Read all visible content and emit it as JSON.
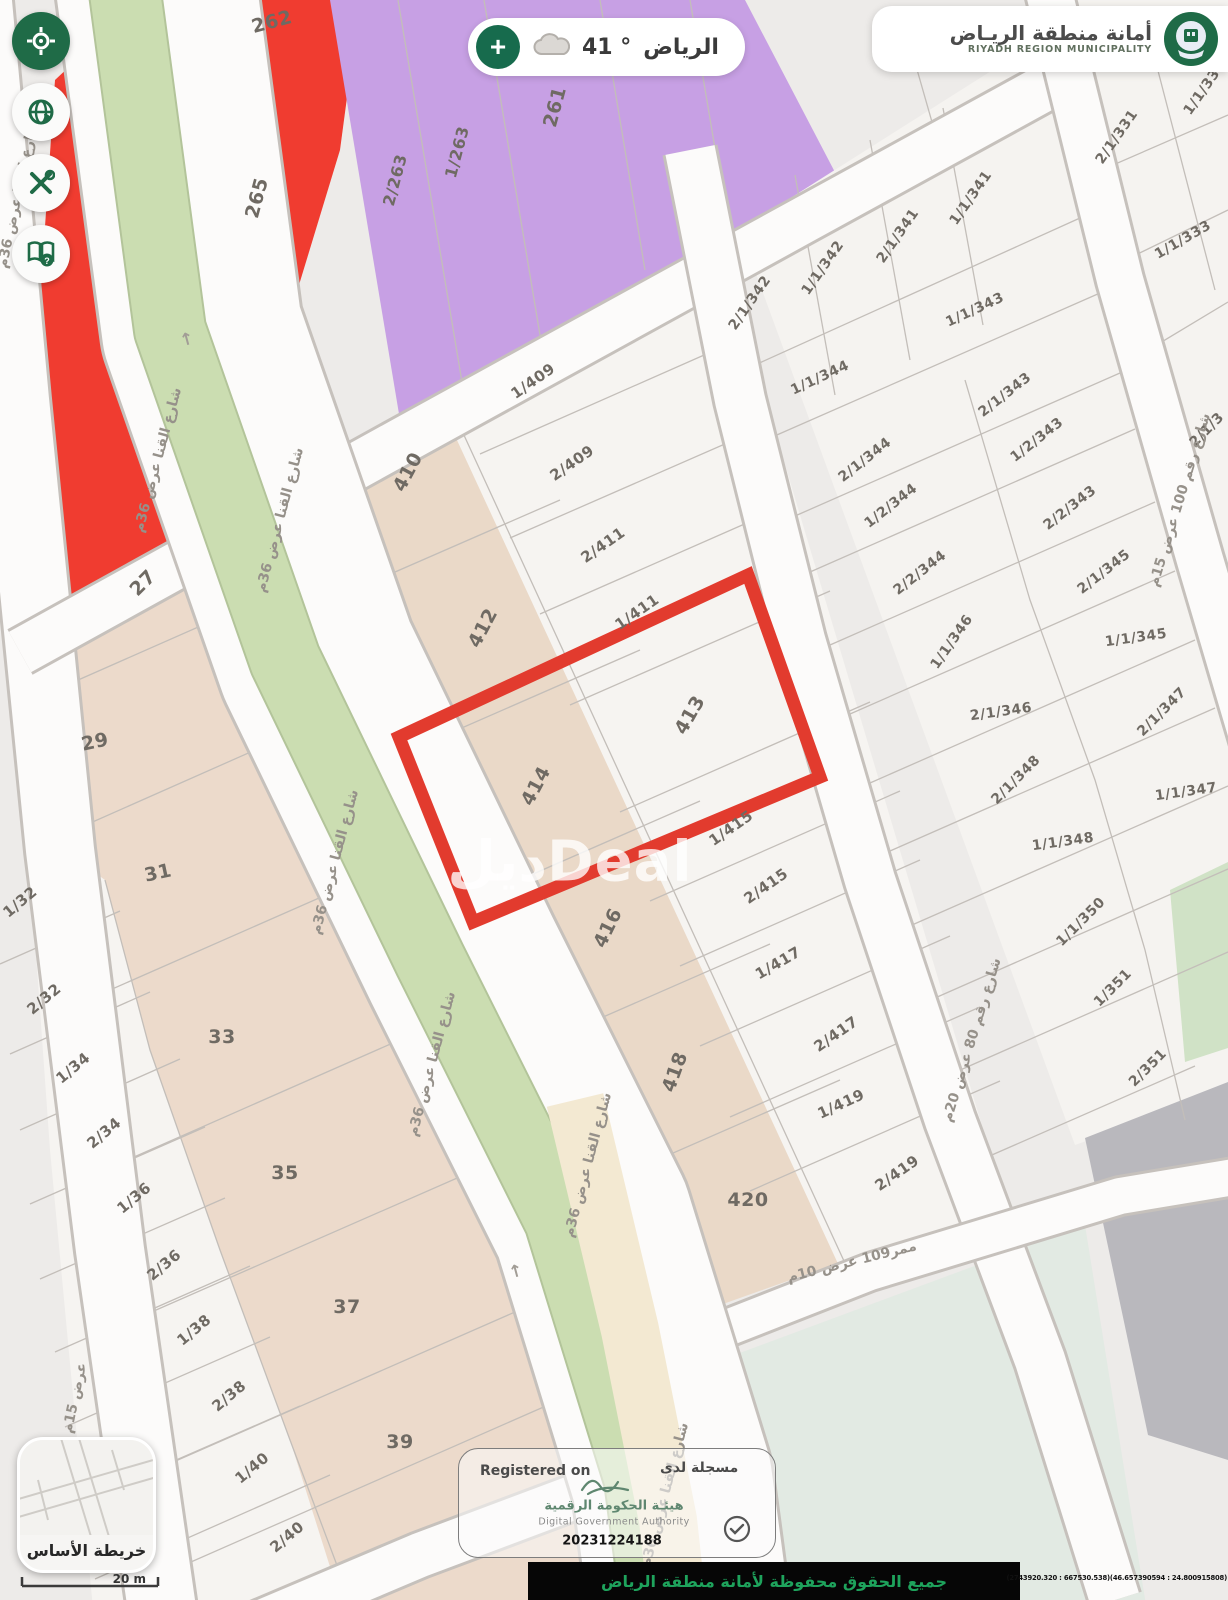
{
  "header": {
    "municipality": {
      "title_ar": "أمانة منطقة الريـاض",
      "title_en": "RIYADH REGION MUNICIPALITY"
    },
    "weather": {
      "city": "الرياض",
      "temp": "41",
      "degree_symbol": "°"
    }
  },
  "toolbar": {
    "buttons": [
      {
        "icon": "locate-target-icon"
      },
      {
        "icon": "globe-icon"
      },
      {
        "icon": "tools-icon"
      },
      {
        "icon": "help-book-icon"
      }
    ]
  },
  "map": {
    "watermark": "ديلDeal",
    "arrow_glyph": "↑",
    "highlight_color": "#e23b2e",
    "colors": {
      "background": "#edebe9",
      "street": "#fcfbfa",
      "street_border": "#c6c1bc",
      "parcel_white": "#f6f4f1",
      "parcel_beige": "#ead9c8",
      "parcel_red": "#f03c30",
      "parcel_purple": "#c7a0e4",
      "median_green": "#cbddb1",
      "parcel_mint": "#e2eae3",
      "parcel_gray": "#b9b8bd",
      "parcel_green": "#d0e2c6",
      "road_cream": "#f3e9d2"
    },
    "parcel_labels": [
      {
        "t": "262",
        "x": 272,
        "y": 22,
        "r": -15,
        "s": 19
      },
      {
        "t": "265",
        "x": 257,
        "y": 198,
        "r": -75,
        "s": 19
      },
      {
        "t": "2/263",
        "x": 395,
        "y": 180,
        "r": -75,
        "s": 16
      },
      {
        "t": "1/263",
        "x": 457,
        "y": 152,
        "r": -75,
        "s": 16
      },
      {
        "t": "261",
        "x": 555,
        "y": 107,
        "r": -75,
        "s": 19
      },
      {
        "t": "410",
        "x": 408,
        "y": 472,
        "r": -62,
        "s": 19
      },
      {
        "t": "412",
        "x": 483,
        "y": 628,
        "r": -62,
        "s": 19
      },
      {
        "t": "414",
        "x": 536,
        "y": 786,
        "r": -62,
        "s": 19
      },
      {
        "t": "416",
        "x": 608,
        "y": 928,
        "r": -64,
        "s": 19
      },
      {
        "t": "418",
        "x": 675,
        "y": 1072,
        "r": -70,
        "s": 19
      },
      {
        "t": "420",
        "x": 748,
        "y": 1200,
        "r": 0,
        "s": 19
      },
      {
        "t": "413",
        "x": 690,
        "y": 715,
        "r": -60,
        "s": 19
      },
      {
        "t": "1/409",
        "x": 533,
        "y": 381,
        "r": -35,
        "s": 15
      },
      {
        "t": "2/409",
        "x": 572,
        "y": 463,
        "r": -35,
        "s": 15
      },
      {
        "t": "2/411",
        "x": 603,
        "y": 545,
        "r": -35,
        "s": 15
      },
      {
        "t": "1/411",
        "x": 637,
        "y": 612,
        "r": -35,
        "s": 15
      },
      {
        "t": "1/415",
        "x": 731,
        "y": 828,
        "r": -35,
        "s": 15
      },
      {
        "t": "2/415",
        "x": 766,
        "y": 886,
        "r": -35,
        "s": 15
      },
      {
        "t": "1/417",
        "x": 778,
        "y": 963,
        "r": -30,
        "s": 15
      },
      {
        "t": "2/417",
        "x": 836,
        "y": 1034,
        "r": -35,
        "s": 15
      },
      {
        "t": "1/419",
        "x": 841,
        "y": 1104,
        "r": -25,
        "s": 15
      },
      {
        "t": "2/419",
        "x": 897,
        "y": 1173,
        "r": -35,
        "s": 15
      },
      {
        "t": "2/1/342",
        "x": 750,
        "y": 303,
        "r": -55,
        "s": 14
      },
      {
        "t": "1/1/342",
        "x": 823,
        "y": 268,
        "r": -55,
        "s": 14
      },
      {
        "t": "2/1/341",
        "x": 898,
        "y": 236,
        "r": -55,
        "s": 14
      },
      {
        "t": "1/1/341",
        "x": 971,
        "y": 198,
        "r": -55,
        "s": 14
      },
      {
        "t": "1/1/343",
        "x": 975,
        "y": 310,
        "r": -25,
        "s": 14
      },
      {
        "t": "1/1/344",
        "x": 820,
        "y": 378,
        "r": -25,
        "s": 14
      },
      {
        "t": "2/1/343",
        "x": 1005,
        "y": 395,
        "r": -38,
        "s": 14
      },
      {
        "t": "2/1/344",
        "x": 865,
        "y": 460,
        "r": -38,
        "s": 14
      },
      {
        "t": "1/2/343",
        "x": 1037,
        "y": 440,
        "r": -38,
        "s": 14
      },
      {
        "t": "1/2/344",
        "x": 891,
        "y": 506,
        "r": -38,
        "s": 14
      },
      {
        "t": "2/2/343",
        "x": 1070,
        "y": 508,
        "r": -38,
        "s": 14
      },
      {
        "t": "2/2/344",
        "x": 920,
        "y": 573,
        "r": -38,
        "s": 14
      },
      {
        "t": "2/1/345",
        "x": 1104,
        "y": 572,
        "r": -38,
        "s": 14
      },
      {
        "t": "1/1/346",
        "x": 952,
        "y": 642,
        "r": -55,
        "s": 14
      },
      {
        "t": "1/1/345",
        "x": 1136,
        "y": 638,
        "r": -8,
        "s": 14
      },
      {
        "t": "2/1/346",
        "x": 1001,
        "y": 712,
        "r": -8,
        "s": 14
      },
      {
        "t": "2/1/347",
        "x": 1162,
        "y": 712,
        "r": -45,
        "s": 14
      },
      {
        "t": "2/1/348",
        "x": 1016,
        "y": 780,
        "r": -45,
        "s": 14
      },
      {
        "t": "1/1/347",
        "x": 1186,
        "y": 792,
        "r": -8,
        "s": 14
      },
      {
        "t": "1/1/348",
        "x": 1063,
        "y": 842,
        "r": -8,
        "s": 14
      },
      {
        "t": "1/1/350",
        "x": 1081,
        "y": 922,
        "r": -45,
        "s": 14
      },
      {
        "t": "1/351",
        "x": 1113,
        "y": 988,
        "r": -45,
        "s": 14
      },
      {
        "t": "2/351",
        "x": 1148,
        "y": 1068,
        "r": -45,
        "s": 14
      },
      {
        "t": "2/1/331",
        "x": 1117,
        "y": 137,
        "r": -55,
        "s": 14
      },
      {
        "t": "1/1/331",
        "x": 1205,
        "y": 88,
        "r": -55,
        "s": 14
      },
      {
        "t": "1/1/333",
        "x": 1183,
        "y": 240,
        "r": -30,
        "s": 14
      },
      {
        "t": "2/1/3",
        "x": 1207,
        "y": 430,
        "r": -45,
        "s": 14
      },
      {
        "t": "27",
        "x": 143,
        "y": 583,
        "r": -45,
        "s": 19
      },
      {
        "t": "29",
        "x": 95,
        "y": 742,
        "r": -12,
        "s": 19
      },
      {
        "t": "31",
        "x": 158,
        "y": 873,
        "r": -12,
        "s": 19
      },
      {
        "t": "33",
        "x": 222,
        "y": 1037,
        "r": 0,
        "s": 19
      },
      {
        "t": "35",
        "x": 285,
        "y": 1173,
        "r": 0,
        "s": 19
      },
      {
        "t": "37",
        "x": 347,
        "y": 1307,
        "r": 0,
        "s": 19
      },
      {
        "t": "39",
        "x": 400,
        "y": 1442,
        "r": 0,
        "s": 19
      },
      {
        "t": "1/32",
        "x": 20,
        "y": 902,
        "r": -40,
        "s": 15
      },
      {
        "t": "2/32",
        "x": 44,
        "y": 999,
        "r": -40,
        "s": 15
      },
      {
        "t": "1/34",
        "x": 73,
        "y": 1068,
        "r": -40,
        "s": 15
      },
      {
        "t": "2/34",
        "x": 104,
        "y": 1133,
        "r": -40,
        "s": 15
      },
      {
        "t": "1/36",
        "x": 134,
        "y": 1198,
        "r": -40,
        "s": 15
      },
      {
        "t": "2/36",
        "x": 164,
        "y": 1265,
        "r": -40,
        "s": 15
      },
      {
        "t": "1/38",
        "x": 194,
        "y": 1330,
        "r": -40,
        "s": 15
      },
      {
        "t": "2/38",
        "x": 229,
        "y": 1396,
        "r": -40,
        "s": 15
      },
      {
        "t": "1/40",
        "x": 252,
        "y": 1468,
        "r": -40,
        "s": 15
      },
      {
        "t": "2/40",
        "x": 287,
        "y": 1537,
        "r": -40,
        "s": 15
      }
    ],
    "street_labels": [
      {
        "t": "شارع القنا عرض 36م",
        "x": 18,
        "y": 195,
        "r": -78
      },
      {
        "t": "شارع القنا عرض 36م",
        "x": 158,
        "y": 460,
        "r": -75
      },
      {
        "t": "شارع القنا عرض 36م",
        "x": 280,
        "y": 520,
        "r": -75
      },
      {
        "t": "شارع القنا عرض 36م",
        "x": 335,
        "y": 862,
        "r": -75
      },
      {
        "t": "شارع القنا عرض 36م",
        "x": 432,
        "y": 1064,
        "r": -75
      },
      {
        "t": "شارع القنا عرض 36م",
        "x": 588,
        "y": 1165,
        "r": -75
      },
      {
        "t": "شارع القنا عرض 36م",
        "x": 665,
        "y": 1495,
        "r": -75
      },
      {
        "t": "عرض 15م",
        "x": 75,
        "y": 1398,
        "r": -78
      },
      {
        "t": "شارع رقم 80 عرض 20م",
        "x": 972,
        "y": 1040,
        "r": -73
      },
      {
        "t": "شارع رقم 100 عرض 15م",
        "x": 1180,
        "y": 500,
        "r": -73
      },
      {
        "t": "ممر109 عرض 10م",
        "x": 852,
        "y": 1262,
        "r": -14
      }
    ],
    "arrows": [
      {
        "x": 187,
        "y": 340,
        "r": -15
      },
      {
        "x": 516,
        "y": 1272,
        "r": -15
      }
    ]
  },
  "basemap_card": {
    "label": "خريطة الأساس",
    "scale": "20 m"
  },
  "registered_badge": {
    "en": "Registered on",
    "ar": "مسجلة لدى",
    "authority_ar": "هيئـة الحكومة الرقمية",
    "authority_en": "Digital Government Authority",
    "number": "20231224188"
  },
  "footer": {
    "rights_ar": "جميع الحقوق محفوظة لأمانة منطقة الرياض",
    "coordinates": "(2743920.320 : 667530.538)(46.657390594 : 24.800915808)"
  }
}
